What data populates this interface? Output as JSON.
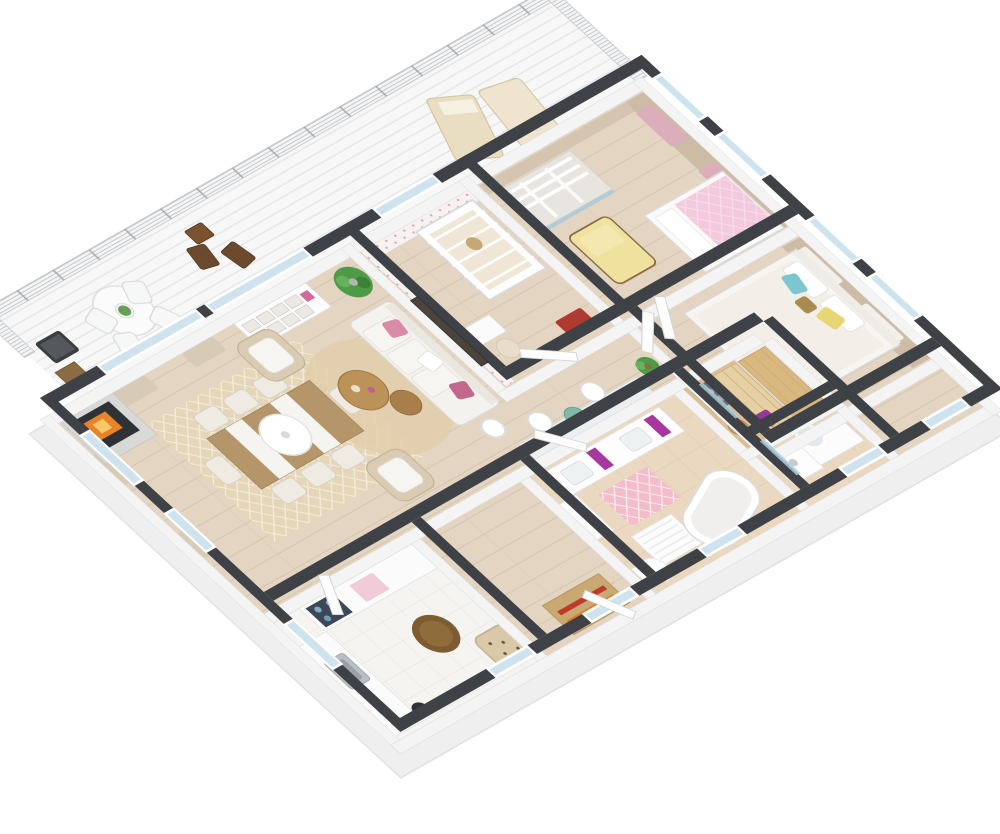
{
  "scene": {
    "kind": "3d-floor-plan-render",
    "view": "isometric-overhead",
    "background": "#ffffff",
    "walls": "white sides with dark charcoal tops",
    "no_visible_text": true
  },
  "colors": {
    "wall_top": "#3e4247",
    "wall_side": "#f4f4f4",
    "wall_skirt": "#efefef",
    "wood_floor": "#e3d5c1",
    "wood_line": "#d6c6af",
    "deck": "#f7f7f8",
    "rail_metal": "#b4b8bb",
    "kitchen_tile": "#f5f4f1",
    "bath_tile": "#ead9c0",
    "sauna_wood": "#dcbe92",
    "sauna_bench": "#e7cfa4",
    "glass": "#cfe3ee",
    "curtain_beige": "#d8cbb6",
    "curtain_pink": "#dcaebc",
    "curtain_white": "#f2f0ec",
    "tan_wall": "#cdbba6",
    "rug_beige": "#e6d6b8",
    "rug_round": "#e0ceac",
    "rug_pink": "#f2bccb",
    "accent_magenta": "#a6379e",
    "accent_pink": "#f2c9dd",
    "accent_yellow": "#efe19e",
    "accent_teal": "#7cc7cf",
    "plant_green": "#4e9b47",
    "fire_orange": "#e8832a",
    "wood_dark": "#6b4a2e",
    "basket_brown": "#7d5c32",
    "sofa_white": "#f4f2ee"
  },
  "rooms": [
    {
      "name": "balcony",
      "floor": "white deck boards",
      "furniture": [
        "round-dining-table",
        "white-armchairs",
        "flower-centerpiece",
        "wood-folding-chairs",
        "wood-side-table",
        "sun-loungers",
        "grill",
        "log-storage",
        "metal-railing"
      ]
    },
    {
      "name": "living-room",
      "floor": "light wood",
      "furniture": [
        "fireplace",
        "sofa",
        "floral-pillows",
        "armchair-north",
        "armchair-south",
        "round-rug",
        "nesting-coffee-tables",
        "floor-lamp",
        "potted-palm",
        "wall-tv",
        "cubby-shelf",
        "window-curtains"
      ]
    },
    {
      "name": "dining-area",
      "floor": "light wood",
      "furniture": [
        "dining-table",
        "table-runners",
        "eight-chairs",
        "pendant-lamp",
        "patterned-rug"
      ]
    },
    {
      "name": "kitchen",
      "floor": "white tile",
      "furniture": [
        "counter-run",
        "sink",
        "cooktop",
        "pink-cloth",
        "wicker-basket-table",
        "patterned-armchair",
        "trash-bin"
      ]
    },
    {
      "name": "entry-hall",
      "floor": "light wood",
      "furniture": [
        "striped-doormat",
        "front-door-glazed"
      ]
    },
    {
      "name": "bathroom",
      "floor": "beige tile",
      "furniture": [
        "double-vanity",
        "magenta-towels",
        "freestanding-bathtub",
        "bath-mat",
        "toilet",
        "pink-lattice-rug",
        "tall-cabinet"
      ]
    },
    {
      "name": "hallway",
      "floor": "light wood",
      "furniture": [
        "makeup-counter",
        "white-chairs",
        "green-glass-table",
        "potted-plant"
      ]
    },
    {
      "name": "sauna",
      "floor": "wood",
      "furniture": [
        "tiered-benches",
        "stone-heater",
        "wooden-bucket",
        "ladle",
        "purple-towel",
        "glass-door"
      ]
    },
    {
      "name": "shower-room",
      "floor": "beige tile",
      "furniture": [
        "shower-tray",
        "shower-head",
        "glass-screen"
      ]
    },
    {
      "name": "nursery",
      "walls": "polka-dot wallpaper",
      "furniture": [
        "crib",
        "teddy-bear",
        "desk",
        "desk-chair",
        "red-toy-cart"
      ]
    },
    {
      "name": "walk-in-closet",
      "furniture": [
        "white-rail-shelving",
        "sliding-glass-doors"
      ]
    },
    {
      "name": "kids-bedroom",
      "walls": "tan with pink curtains",
      "furniture": [
        "yellow-chaise",
        "bed-pink-cover",
        "windows-pink-curtains"
      ]
    },
    {
      "name": "master-bedroom",
      "walls": "tan with white curtains",
      "furniture": [
        "double-bed",
        "teal-pillow",
        "yellow-pillow",
        "dresser",
        "round-mirror",
        "windows-white-curtains"
      ]
    }
  ]
}
